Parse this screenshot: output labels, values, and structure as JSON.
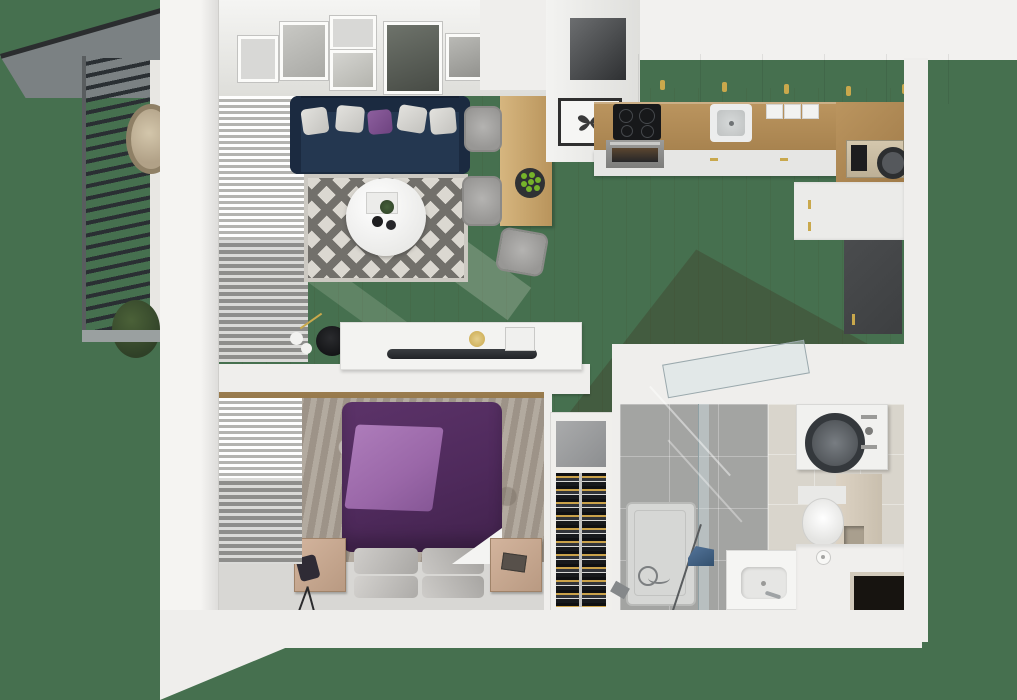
{
  "scene": {
    "type": "3d-floor-plan-top-view-render",
    "rooms": [
      {
        "name": "balcony",
        "features": [
          "slatted-privacy-screen",
          "mesh-roof",
          "hanging-egg-chair",
          "potted-plant",
          "railing"
        ]
      },
      {
        "name": "living-room",
        "features": [
          "navy-sofa",
          "gray-pillows",
          "purple-pillow",
          "diamond-pattern-rug",
          "round-white-coffee-table",
          "serving-tray",
          "black-cups",
          "side-table",
          "white-vases",
          "potted-plant",
          "tv-sideboard",
          "flat-tv",
          "gallery-wall-frames",
          "window-blinds"
        ]
      },
      {
        "name": "dining-nook",
        "features": [
          "wood-dining-table",
          "three-gray-chairs",
          "plate-of-green-apples"
        ]
      },
      {
        "name": "kitchen",
        "features": [
          "upper-cabinets-with-brass-handles",
          "wood-countertop",
          "induction-hob",
          "oven",
          "inset-sink",
          "canisters",
          "coffee-machine",
          "base-cabinets",
          "tall-dark-cabinet",
          "butterfly-artwork",
          "ventilation-recess"
        ]
      },
      {
        "name": "bedroom",
        "features": [
          "purple-double-bed",
          "light-purple-throw",
          "gray-pillows",
          "white-sheet",
          "mottled-rug",
          "wood-nightstand-left",
          "wood-nightstand-right",
          "bag",
          "tripod",
          "book",
          "window-blinds"
        ]
      },
      {
        "name": "hallway",
        "features": [
          "wine-rack-column",
          "wine-rack-shelf",
          "entry-door-leaf"
        ]
      },
      {
        "name": "bathroom",
        "features": [
          "gray-floor-tiles",
          "beige-floor-tiles",
          "shower-tray",
          "glass-screen",
          "open-glass-door",
          "handheld-shower",
          "washing-machine",
          "wall-hung-toilet",
          "beige-partition-wall",
          "vanity-basin",
          "faucet",
          "bench-counter",
          "toilet-paper-roll",
          "iron",
          "window-recess",
          "wine-rack-shelf"
        ]
      }
    ],
    "palette": {
      "bg-green": "#46704f",
      "wall": "#efeeec",
      "wall-dim": "#dddcd9",
      "wood": "#c2a06c",
      "wood-light": "#cbab76",
      "wood-dark": "#a68a59",
      "wood-strip": "#8a6f45",
      "counter-wood": "#b28c59",
      "navy": "#243750",
      "navy-dark": "#1b2a40",
      "purple": "#4f2a5c",
      "purple-light": "#9a67a8",
      "rug-base": "#dbd8d1",
      "rug-dia": "#72706b",
      "bedrug": "#a89e92",
      "tile-gray": "#a3a4a2",
      "tile-beige": "#d9d5cc",
      "dark-unit": "#3d3f41",
      "slat": "#2a2f33",
      "mesh": "#7b8183",
      "brass": "#c9a84c",
      "chair": "#a3a2a0",
      "apple": "#76b32a",
      "blind-light": "#e9e8e5",
      "blind-dark": "#8e8e8c",
      "white-obj": "#f2f2f0",
      "glass": "rgba(210,225,228,0.45)",
      "rack-dark": "#202226",
      "tan": "#c7a690",
      "shadow": "rgba(62,48,30,0.30)"
    }
  }
}
